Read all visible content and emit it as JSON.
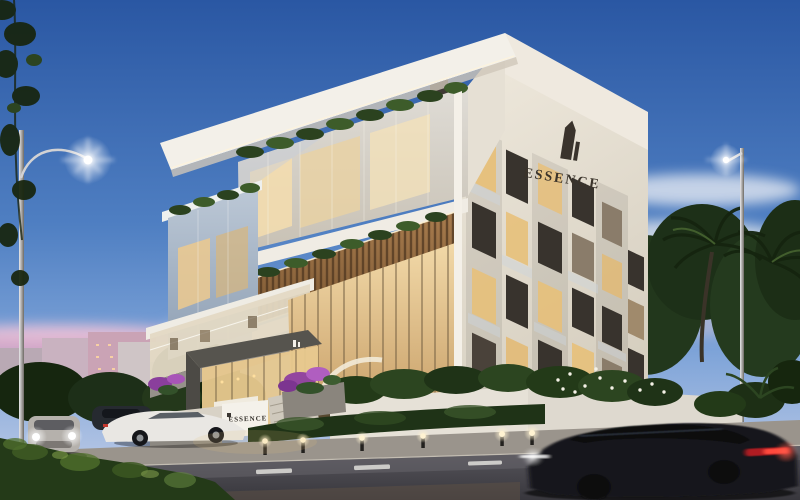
{
  "scene": {
    "description": "Dusk architectural rendering of a modern luxury residential building with glass facades, rooftop planters, street lamps, palm trees and passing cars",
    "branding": {
      "building_sign": "ESSENCE",
      "entrance_sign": "ESSENCE"
    },
    "palette": {
      "sky_top": "#2a57a3",
      "sky_mid": "#5d8bc9",
      "sky_horizon": "#c8d3ea",
      "cloud_pink": "#e2a9c6",
      "cloud_light": "#dde4ee",
      "facade_white": "#f2efe8",
      "facade_shadow": "#d9d2c4",
      "warm_window": "#e7c07a",
      "interior_glow": "#f2d9a8",
      "wood_slats": "#a87c4e",
      "foliage": "#2c4420",
      "foliage_dark": "#1f3317",
      "road": "#45444a",
      "lane_marking": "#d9d8d4",
      "taillight_red": "#ff4a3c",
      "headlight_white": "#ffffff",
      "flowers_purple": "#9b4fae"
    }
  }
}
